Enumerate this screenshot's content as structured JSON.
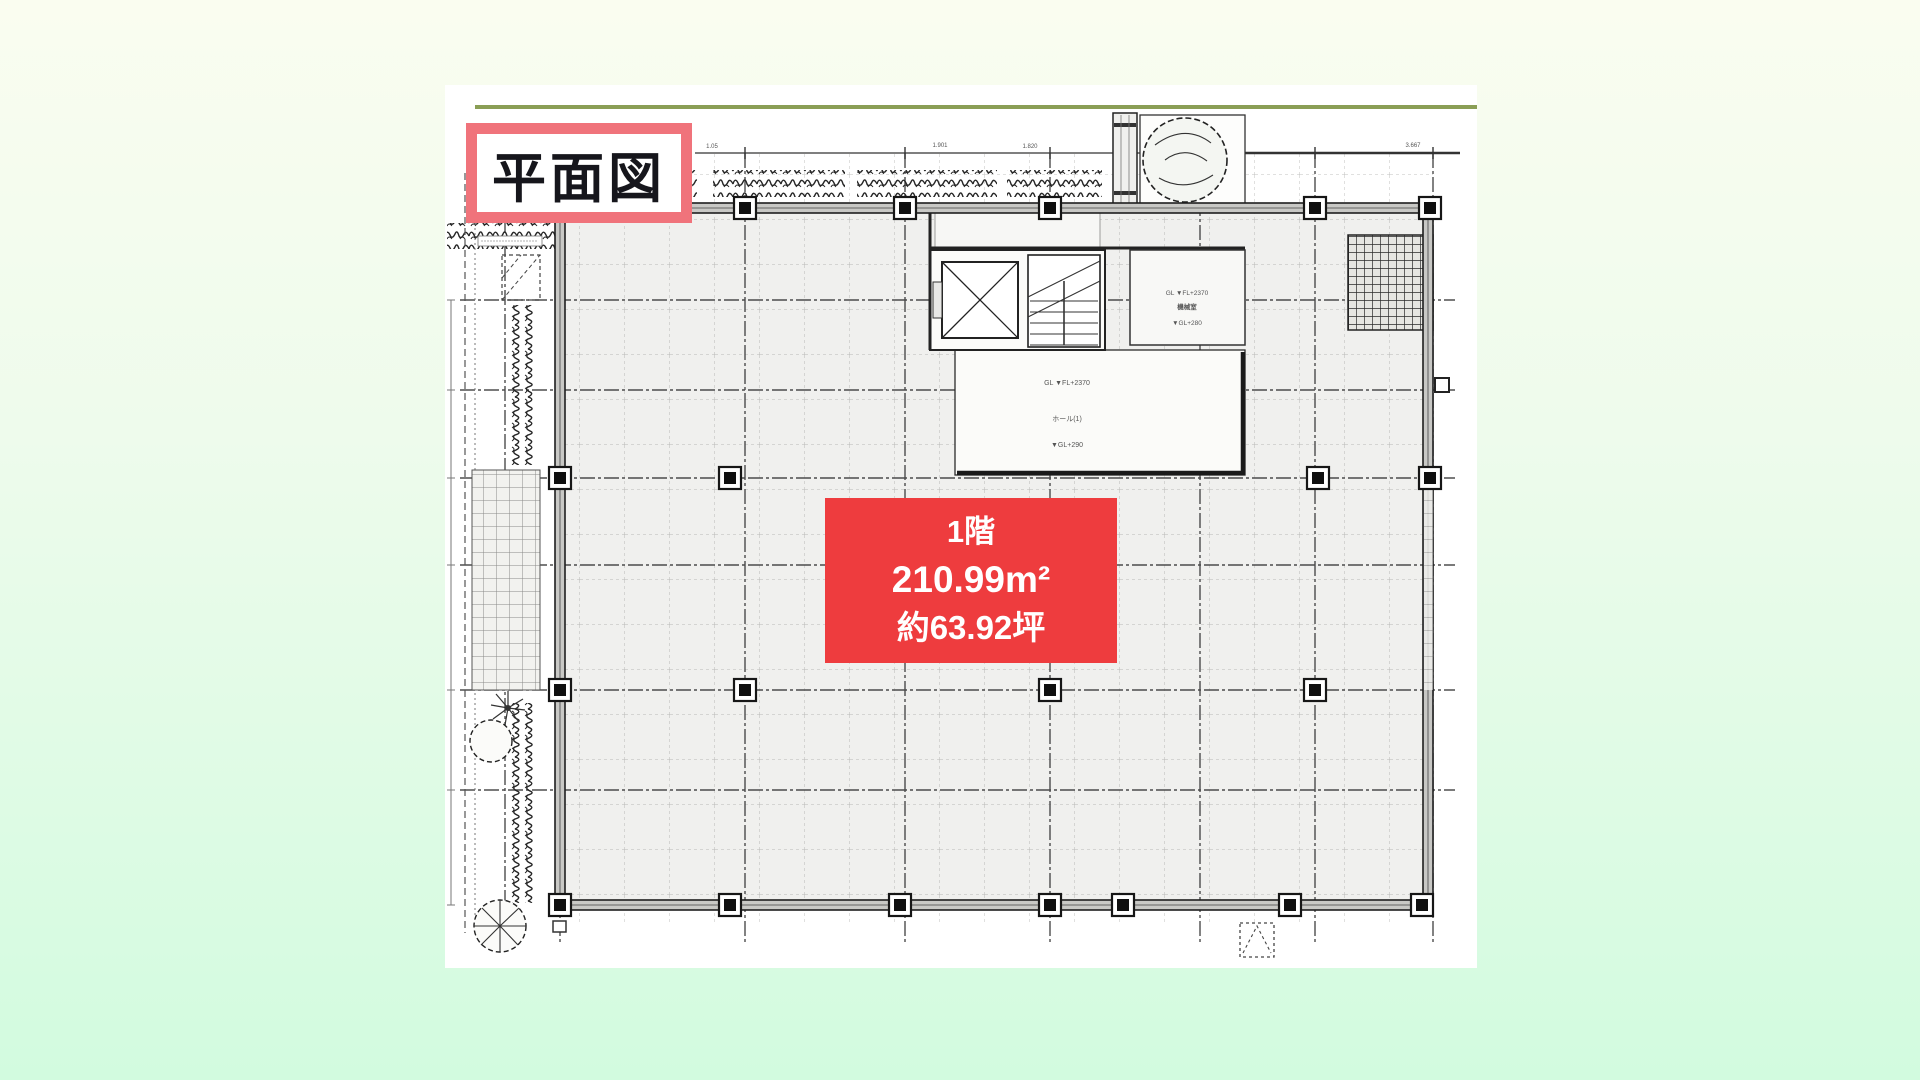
{
  "drawing": {
    "title_label": "平面図",
    "unit_label": {
      "floor": "1階",
      "area_m2": "210.99m²",
      "area_tsubo": "約63.92坪"
    },
    "annotations": {
      "top_dimensions": [
        "1.05",
        "1.901",
        "1.820",
        "3.667"
      ],
      "machine_room": {
        "line1": "GL ▼FL+2370",
        "line2": "機械室",
        "line3": "▼GL+280"
      },
      "hall": {
        "line1": "GL ▼FL+2370",
        "line2": "ホール(1)",
        "line3": "▼GL+290"
      }
    },
    "colors": {
      "unit_label_bg": "#ee3c3e",
      "title_border": "#f0737b",
      "accent_line": "#8a9e55",
      "plan_line": "#2b2b2b",
      "background_top": "#fafdf0",
      "background_bottom": "#d2fbdf"
    }
  }
}
